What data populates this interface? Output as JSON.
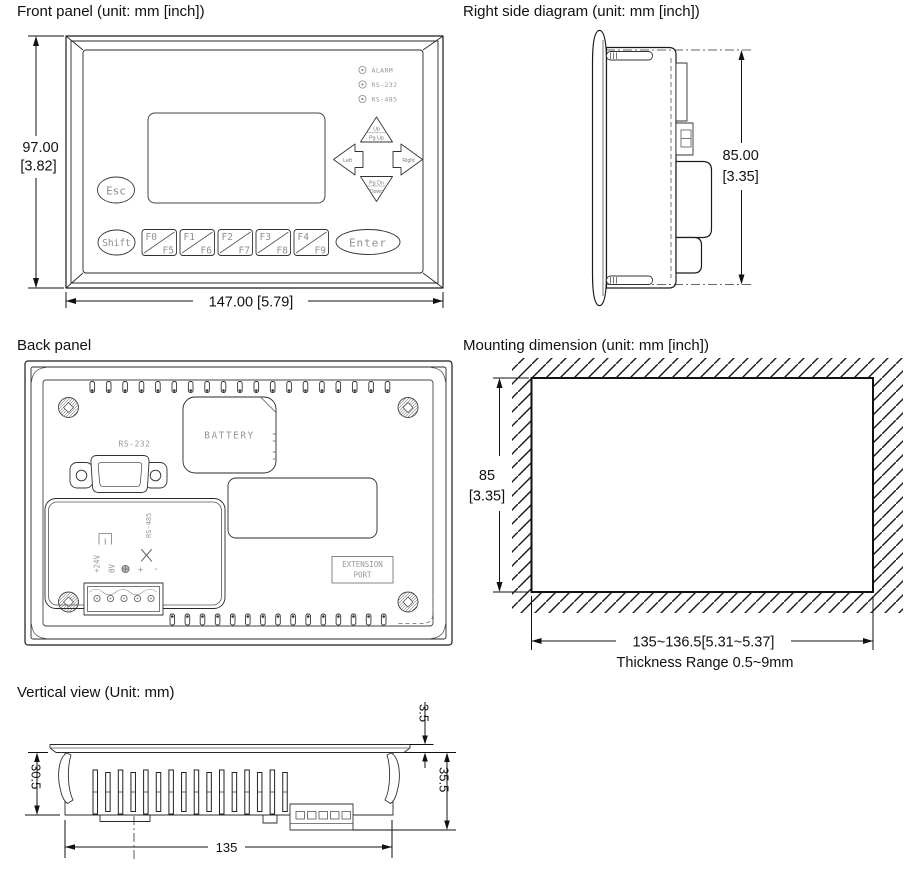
{
  "front": {
    "title": "Front panel (unit: mm [inch])",
    "dim_height_mm": "97.00",
    "dim_height_in": "[3.82]",
    "dim_width": "147.00 [5.79]",
    "leds": [
      {
        "label": "ALARM"
      },
      {
        "label": "RS-232"
      },
      {
        "label": "RS-485"
      }
    ],
    "esc_label": "Esc",
    "shift_label": "Shift",
    "enter_label": "Enter",
    "fkeys": [
      {
        "top": "F0",
        "bottom": "F5"
      },
      {
        "top": "F1",
        "bottom": "F6"
      },
      {
        "top": "F2",
        "bottom": "F7"
      },
      {
        "top": "F3",
        "bottom": "F8"
      },
      {
        "top": "F4",
        "bottom": "F9"
      }
    ],
    "nav": {
      "up": "Up",
      "pg_up": "Pg Up",
      "left": "Left",
      "right": "Right",
      "pg_dn": "Pg Dn",
      "down": "Down"
    }
  },
  "side": {
    "title": "Right side diagram (unit: mm [inch])",
    "dim_height_mm": "85.00",
    "dim_height_in": "[3.35]"
  },
  "back": {
    "title": "Back panel",
    "rs232_label": "RS-232",
    "battery_label": "BATTERY",
    "extension_line1": "EXTENSION",
    "extension_line2": "PORT",
    "rs485_label": "RS-485",
    "v24_label": "+24V",
    "v0_label": "0V",
    "plus_label": "+",
    "minus_label": "-"
  },
  "mount": {
    "title": "Mounting dimension (unit: mm [inch])",
    "dim_height_mm": "85",
    "dim_height_in": "[3.35]",
    "dim_width": "135~136.5[5.31~5.37]",
    "thickness_note": "Thickness Range 0.5~9mm"
  },
  "vertical": {
    "title": "Vertical view (Unit: mm)",
    "dim_bezel": "3.5",
    "dim_depth": "35.5",
    "dim_body": "30.5",
    "dim_width": "135"
  }
}
